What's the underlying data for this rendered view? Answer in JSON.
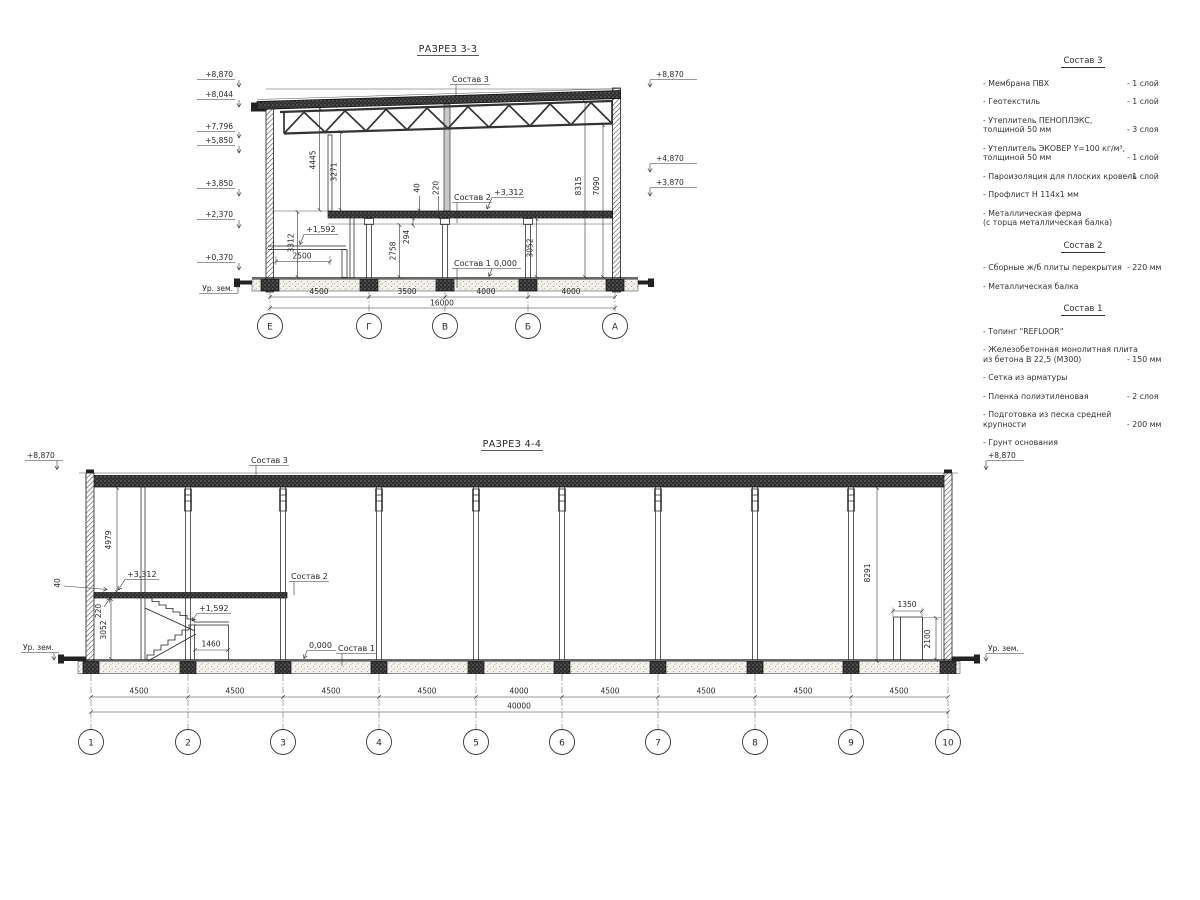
{
  "titles": {
    "s33": "РАЗРЕЗ 3-3",
    "s44": "РАЗРЕЗ 4-4"
  },
  "s33": {
    "elev_left": [
      "+8,870",
      "+8,044",
      "+7,796",
      "+5,850",
      "+3,850",
      "+2,370",
      "+0,370"
    ],
    "ground_label": "Ур. зем.",
    "elev_right": [
      "+8,870",
      "+4,870",
      "+3,870"
    ],
    "layers3": "Состав 3",
    "layers2": "Состав 2",
    "layers1": "Состав 1",
    "lvl_3312": "+3,312",
    "lvl_0": "0,000",
    "lvl_1592": "+1,592",
    "dim_4445": "4445",
    "dim_3271": "3271",
    "dim_3312": "3312",
    "dim_2758": "2758",
    "dim_294": "294",
    "dim_3052": "3052",
    "dim_8315": "8315",
    "dim_7090": "7090",
    "dim_40": "40",
    "dim_220": "220",
    "dim_2500": "2500",
    "bay_dims": [
      "4500",
      "3500",
      "4000",
      "4000"
    ],
    "total_dim": "16000",
    "grids": [
      "Е",
      "Г",
      "В",
      "Б",
      "А"
    ]
  },
  "s44": {
    "elev_left": "+8,870",
    "elev_right": "+8,870",
    "ground_label_left": "Ур. зем.",
    "ground_label_right": "Ур. зем.",
    "layers3": "Состав 3",
    "layers2": "Состав 2",
    "layers1": "Состав 1",
    "lvl_3312": "+3,312",
    "lvl_0": "0,000",
    "lvl_1592": "+1,592",
    "dim_4979": "4979",
    "dim_40": "40",
    "dim_220": "220",
    "dim_3052": "3052",
    "dim_1460": "1460",
    "dim_8291": "8291",
    "dim_1350": "1350",
    "dim_2100": "2100",
    "bay_dims": [
      "4500",
      "4500",
      "4500",
      "4500",
      "4000",
      "4500",
      "4500",
      "4500",
      "4500"
    ],
    "total_dim": "40000",
    "grids": [
      "1",
      "2",
      "3",
      "4",
      "5",
      "6",
      "7",
      "8",
      "9",
      "10"
    ]
  },
  "legend": {
    "g3": {
      "title": "Состав 3",
      "items": [
        {
          "l1": "- Мембрана ПВХ",
          "v": "- 1 слой"
        },
        {
          "l1": "- Геотекстиль",
          "v": "- 1 слой"
        },
        {
          "l1": "- Утеплитель ПЕНОПЛЭКС,",
          "l2": "толщиной 50 мм",
          "v": "- 3 слоя"
        },
        {
          "l1": "- Утеплитель ЭКОВЕР Y=100 кг/м³,",
          "l2": "толщиной 50 мм",
          "v": "- 1 слой"
        },
        {
          "l1": "- Пароизоляция для плоских кровель",
          "v": "- 1 слой"
        },
        {
          "l1": "- Профлист Н 114х1 мм"
        },
        {
          "l1": "- Металлическая ферма",
          "l2": "(с торца металлическая балка)"
        }
      ]
    },
    "g2": {
      "title": "Состав 2",
      "items": [
        {
          "l1": "- Сборные ж/б плиты перекрытия",
          "v": "- 220 мм"
        },
        {
          "l1": "- Металлическая балка"
        }
      ]
    },
    "g1": {
      "title": "Состав 1",
      "items": [
        {
          "l1": "- Топинг \"REFLOOR\""
        },
        {
          "l1": "- Железобетонная  монолитная плита",
          "l2": "из бетона В 22,5 (М300)",
          "v": "- 150 мм"
        },
        {
          "l1": "- Сетка из арматуры"
        },
        {
          "l1": "- Пленка полиэтиленовая",
          "v": "- 2 слоя"
        },
        {
          "l1": "- Подготовка из песка средней",
          "l2": "крупности",
          "v": "- 200 мм"
        },
        {
          "l1": "- Грунт основания"
        }
      ]
    }
  }
}
